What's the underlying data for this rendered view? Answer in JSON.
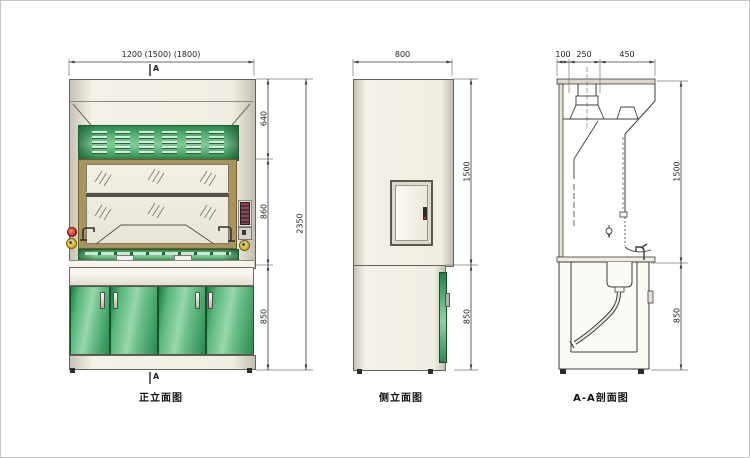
{
  "drawing": {
    "views": {
      "front": {
        "label": "正立面图",
        "section_marker": "A",
        "dims": {
          "width": "1200 (1500) (1800)",
          "hood_height": "640",
          "sash_height": "860",
          "cabinet_height": "850",
          "total_height": "2350"
        }
      },
      "side": {
        "label": "侧立面图",
        "dims": {
          "depth": "800",
          "upper_height": "1500",
          "cabinet_height": "850"
        }
      },
      "section": {
        "label": "A-A剖面图",
        "dims": {
          "rear": "100",
          "duct": "250",
          "front": "450",
          "upper_height": "1500",
          "cabinet_height": "850"
        }
      }
    },
    "colors": {
      "body_cream": "#eceade",
      "panel_green": "#3fa45c",
      "frame_tan": "#a8945c",
      "line": "#4a4a44",
      "accent_red": "#cc3b2f",
      "accent_yellow": "#e3bf3b",
      "accent_blue": "#2c4fa3"
    }
  }
}
